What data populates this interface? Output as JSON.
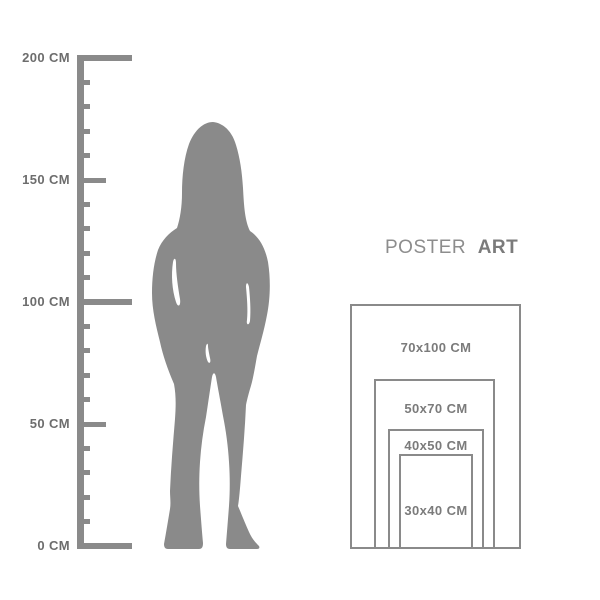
{
  "colors": {
    "background": "#ffffff",
    "figure": "#8a8a8a",
    "ruler": "#8a8a8a",
    "ruler_label": "#6d6d6d",
    "frame_border": "#8a8a8a",
    "size_label": "#7b7b7b",
    "title_regular": "#8d8d8d",
    "title_bold": "#7b7b7b"
  },
  "ruler": {
    "unit": "CM",
    "max_cm": 200,
    "tick_step_cm": 10,
    "labeled_ticks": [
      {
        "cm": 200,
        "label": "200 CM"
      },
      {
        "cm": 150,
        "label": "150 CM"
      },
      {
        "cm": 100,
        "label": "100 CM"
      },
      {
        "cm": 50,
        "label": "50 CM"
      },
      {
        "cm": 0,
        "label": "0 CM"
      }
    ]
  },
  "figure": {
    "description": "gray silhouette of a standing woman with long hair, approx 175 cm tall against the ruler"
  },
  "poster_panel": {
    "title": {
      "word1": "POSTER",
      "word2": "ART"
    },
    "sizes": [
      {
        "label": "70x100 CM",
        "width_cm": 70,
        "height_cm": 100
      },
      {
        "label": "50x70 CM",
        "width_cm": 50,
        "height_cm": 70
      },
      {
        "label": "40x50 CM",
        "width_cm": 40,
        "height_cm": 50
      },
      {
        "label": "30x40 CM",
        "width_cm": 30,
        "height_cm": 40
      }
    ]
  }
}
